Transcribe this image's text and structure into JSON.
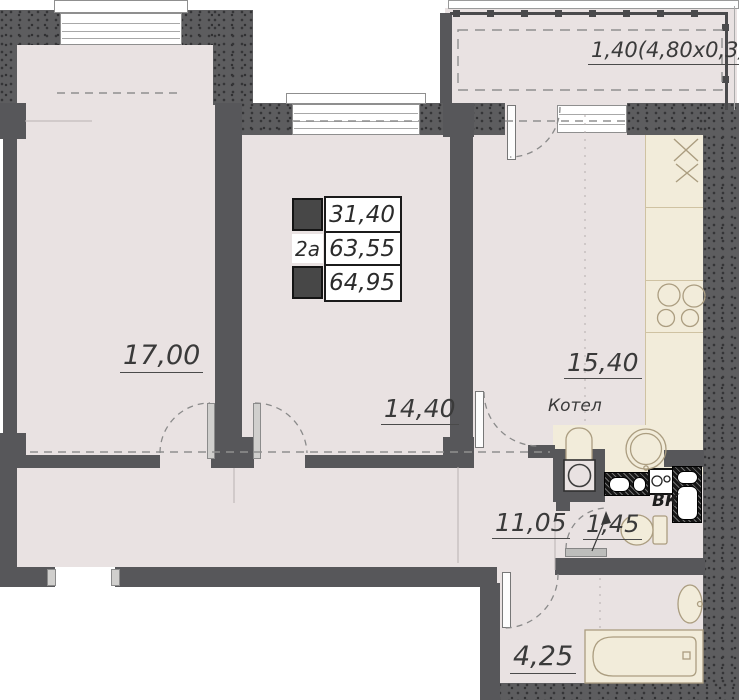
{
  "type": "apartment-floor-plan",
  "legend": {
    "unit": "2a",
    "areas": [
      "31,40",
      "63,55",
      "64,95"
    ]
  },
  "rooms": {
    "living": {
      "area": "17,00"
    },
    "bedroom": {
      "area": "14,40"
    },
    "kitchen": {
      "area": "15,40"
    },
    "hall": {
      "area": "11,05"
    },
    "wc": {
      "area": "1,45"
    },
    "bath": {
      "area": "4,25"
    },
    "balcony": {
      "area": "1,40(4,80x0,3)"
    }
  },
  "annotations": {
    "boiler": "Котел",
    "water_duct": "ВК"
  },
  "colors": {
    "floor": "#e9e2e2",
    "counter": "#f2ecda",
    "inner_wall": "#57575a",
    "outer_wall": "#5d5d5f",
    "fixture_line": "#ab9d80",
    "label": "#3a3a3a"
  }
}
